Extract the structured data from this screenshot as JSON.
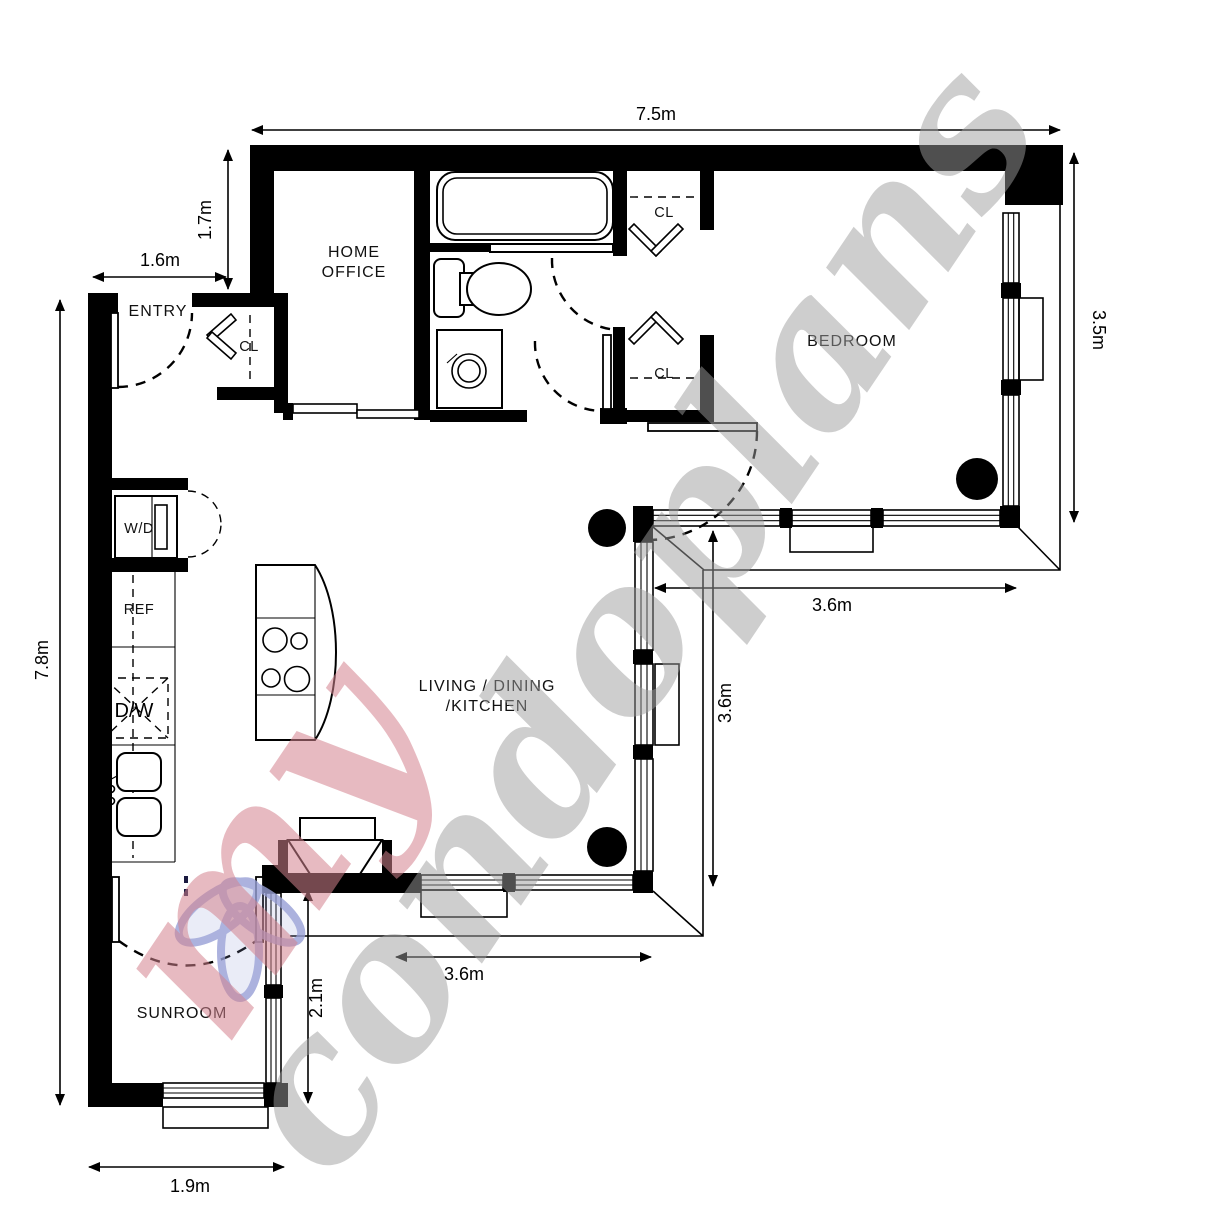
{
  "rooms": {
    "home_office": {
      "line1": "HOME",
      "line2": "OFFICE"
    },
    "entry": {
      "label": "ENTRY"
    },
    "bedroom": {
      "label": "BEDROOM"
    },
    "living": {
      "line1": "LIVING / DINING",
      "line2": "/KITCHEN"
    },
    "sunroom": {
      "label": "SUNROOM"
    },
    "closet_entry": {
      "label": "CL"
    },
    "closet_top": {
      "label": "CL"
    },
    "closet_bottom": {
      "label": "CL"
    }
  },
  "appliances": {
    "washer_dryer": "W/D",
    "refrigerator": "REF",
    "dishwasher": "D/W"
  },
  "dimensions": {
    "top_width": "7.5m",
    "office_depth": "1.7m",
    "entry_width": "1.6m",
    "left_height": "7.8m",
    "bedroom_depth": "3.5m",
    "bedroom_width": "3.6m",
    "living_depth": "3.6m",
    "living_width": "3.6m",
    "sunroom_depth": "2.1m",
    "sunroom_width": "1.9m"
  },
  "watermark": {
    "prefix": "my",
    "suffix": "condoplans",
    "prefix_color": "#d4838f",
    "suffix_color": "#9e9e9e",
    "flower_color": "#98a0d6"
  },
  "colors": {
    "walls": "#000000",
    "background": "#ffffff"
  }
}
